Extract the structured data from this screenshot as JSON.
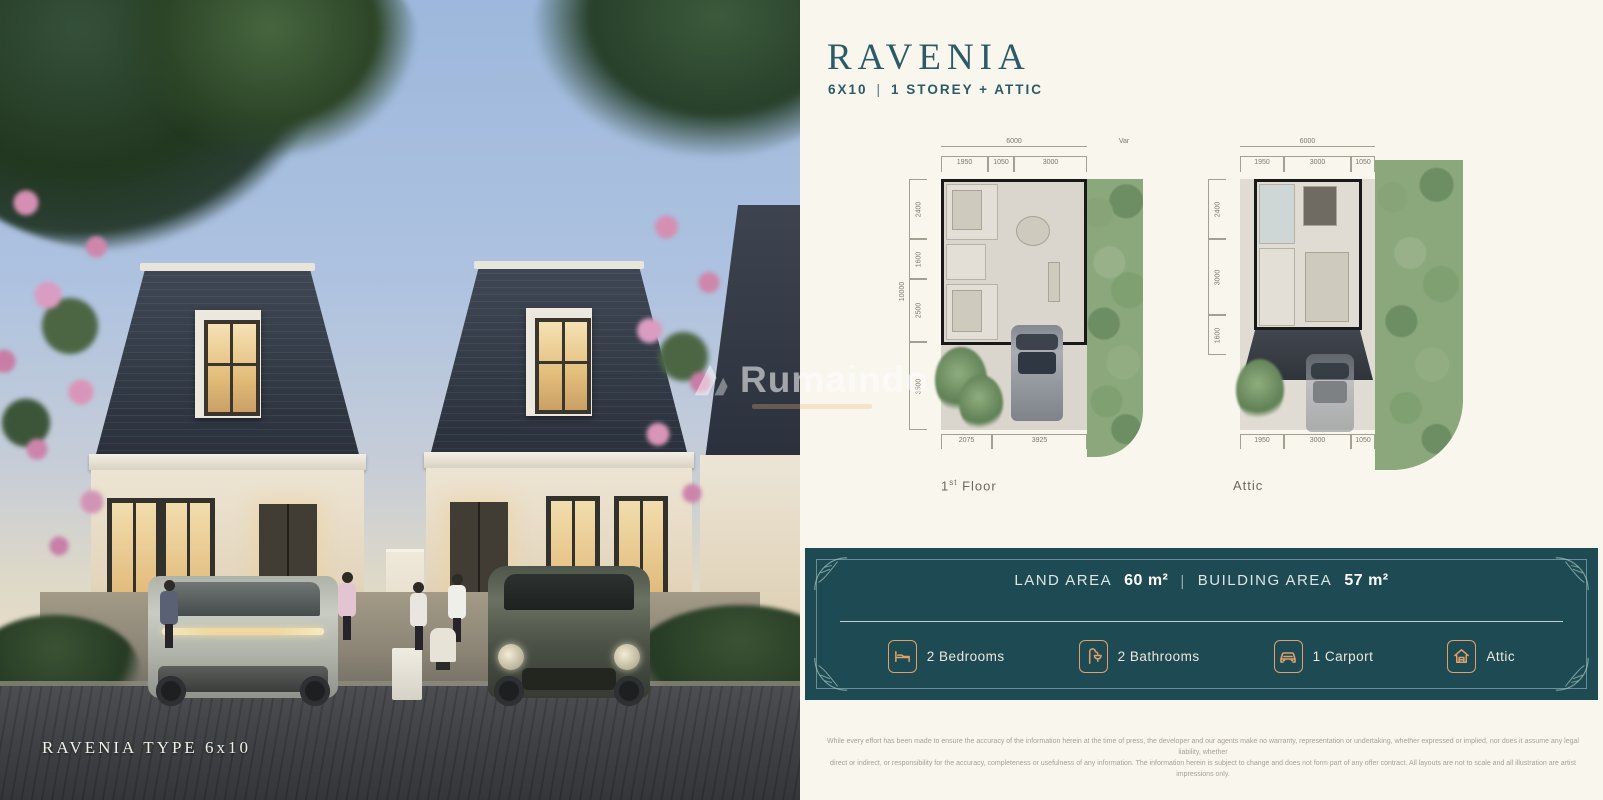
{
  "photo": {
    "caption": "RAVENIA  TYPE  6x10",
    "watermark": "Rumaindo"
  },
  "header": {
    "title": "RAVENIA",
    "size": "6X10",
    "separator": "|",
    "type": "1 STOREY + ATTIC"
  },
  "plans": {
    "first": {
      "top_total": "6000",
      "top_var": "Var",
      "top_dims": [
        "1950",
        "1050",
        "3000"
      ],
      "left_total": "10000",
      "left_dims": [
        "2400",
        "1600",
        "2500",
        "3500"
      ],
      "bottom_dims": [
        "2075",
        "3925"
      ],
      "label_num": "1",
      "label_sup": "st",
      "label_word": "Floor"
    },
    "attic": {
      "top_total": "6000",
      "top_dims": [
        "1950",
        "3000",
        "1050"
      ],
      "left_dims": [
        "2400",
        "3000",
        "1600"
      ],
      "bottom_dims": [
        "1950",
        "3000",
        "1050"
      ],
      "label": "Attic"
    }
  },
  "banner": {
    "land_area_label": "LAND AREA",
    "land_area_value": "60 m²",
    "separator": "|",
    "building_area_label": "BUILDING AREA",
    "building_area_value": "57 m²",
    "features": [
      {
        "icon": "bed-icon",
        "label": "2 Bedrooms"
      },
      {
        "icon": "bathroom-icon",
        "label": "2 Bathrooms"
      },
      {
        "icon": "car-icon",
        "label": "1 Carport"
      },
      {
        "icon": "attic-icon",
        "label": "Attic"
      }
    ]
  },
  "disclaimer": {
    "line1": "While every effort has been made to ensure the accuracy of the information herein at the time of press, the developer and our agents make no warranty, representation or undertaking, whether expressed or implied, nor does it assume any legal liability, whether",
    "line2": "direct or indirect, or responsibility for the accuracy, completeness or usefulness of any information. The information herein is subject to change and does not form part of any offer contract. All layouts are not to scale and all illustration are artist impressions only."
  },
  "colors": {
    "panel_cream": "#f9f6ee",
    "banner_teal": "#1e4b53",
    "title_teal": "#2c5a66",
    "icon_orange": "#dfa06a",
    "plan_green": "#8aa87c"
  }
}
